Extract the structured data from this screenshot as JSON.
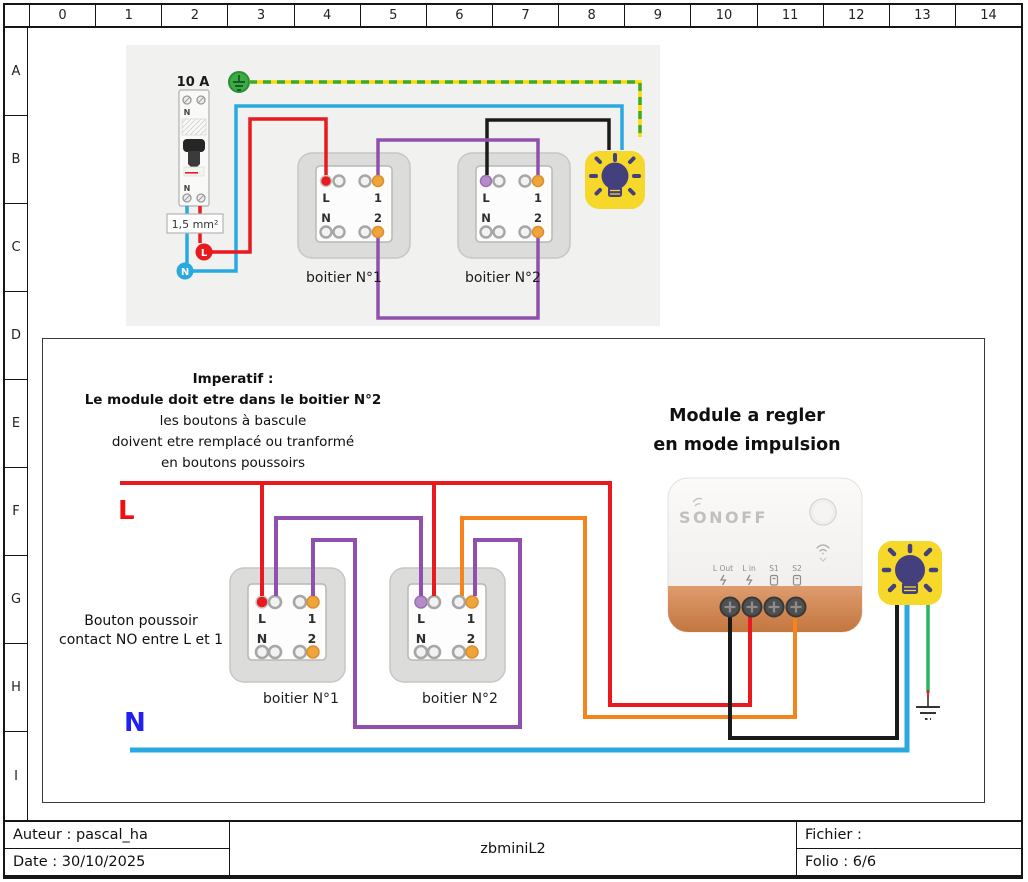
{
  "grid": {
    "cols": [
      "0",
      "1",
      "2",
      "3",
      "4",
      "5",
      "6",
      "7",
      "8",
      "9",
      "10",
      "11",
      "12",
      "13",
      "14"
    ],
    "rows": [
      "A",
      "B",
      "C",
      "D",
      "E",
      "F",
      "G",
      "H",
      "I"
    ]
  },
  "title_block": {
    "author": "Auteur : pascal_ha",
    "date": "Date : 30/10/2025",
    "doc": "zbminiL2",
    "file": "Fichier :",
    "folio": "Folio : 6/6"
  },
  "terminals": {
    "live": "L",
    "one": "1",
    "neutral": "N",
    "two": "2"
  },
  "top_diagram": {
    "breaker_rating": "10 A",
    "breaker_neutral": "N",
    "wire_gauge": "1,5 mm²",
    "live_label": "L",
    "neutral_label": "N",
    "box1_caption": "boitier N°1",
    "box2_caption": "boitier N°2"
  },
  "bottom_diagram": {
    "imperatif": [
      "Imperatif :",
      "Le module doit etre dans le boitier N°2",
      "les boutons à bascule",
      "doivent etre remplacé ou tranformé",
      "en  boutons poussoirs"
    ],
    "module_note": [
      "Module a regler",
      "en mode impulsion"
    ],
    "bouton_note": [
      "Bouton poussoir",
      "contact NO entre L et 1"
    ],
    "live_label": "L",
    "neutral_label": "N",
    "box1_caption": "boitier N°1",
    "box2_caption": "boitier N°2"
  },
  "module": {
    "brand": "SONOFF",
    "terminals": [
      "L Out",
      "L in",
      "S1",
      "S2"
    ]
  },
  "colors": {
    "live": "#e8191f",
    "neutral": "#29a9e0",
    "switched": "#1a1a1a",
    "shuttle": "#9051ae",
    "s2_wire": "#f5841e",
    "earth_green": "#3aaa35",
    "earth_yellow": "#ffd900",
    "ground_green": "#2eb467",
    "lamp_yellow": "#f5d829",
    "lamp_bulb": "#44407d",
    "module_band": "#cf8350",
    "terminal_orange": "#f0a43c",
    "terminal_lavender": "#b48cc8"
  }
}
